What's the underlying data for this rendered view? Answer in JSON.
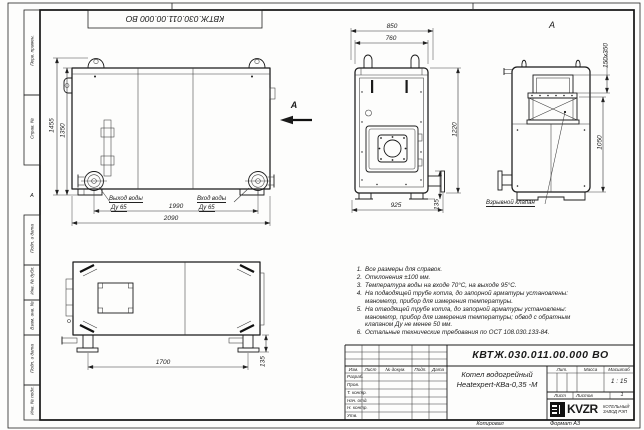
{
  "doc": {
    "number": "КВТЖ.030.011.00.000 ВО",
    "name_line1": "Котел водогрейный",
    "name_line2": "Heatexpert-КВа-0,35 -М",
    "scale_value": "1 : 15",
    "sheets_value": "1",
    "copy_label": "Копировал",
    "format_label": "Формат А3"
  },
  "frame": {
    "zone_letter": "А",
    "margin_labels": [
      "Перв. примен.",
      "Справ. №",
      "Подп. и дата",
      "Инв. № дубл.",
      "Взам. инв. №",
      "Подп. и дата",
      "Инв. № подл."
    ]
  },
  "titleblock": {
    "col_headers": [
      "Изм.",
      "Лист",
      "№ докум.",
      "Подп.",
      "Дата"
    ],
    "row_labels": [
      "Разраб.",
      "Пров.",
      "Т. контр.",
      "Нач. отд.",
      "Н. контр.",
      "Утв."
    ],
    "lit_label": "Лит.",
    "mass_label": "Масса",
    "scale_label": "Масштаб",
    "sheet_label": "Лист",
    "sheets_label": "Листов"
  },
  "logo": {
    "brand": "KVZR",
    "factory_line1": "КОТЕЛЬНЫЙ",
    "factory_line2": "ЗАВОД РЭП"
  },
  "views": {
    "side": {
      "dim_height_total": "1455",
      "dim_height_body": "1350",
      "dim_span_flanges": "1990",
      "dim_width_total": "2090",
      "outlet_label": "Выход воды",
      "outlet_dn": "Ду 65",
      "inlet_label": "Вход воды",
      "inlet_dn": "Ду 65",
      "view_arrow_label": "А"
    },
    "front": {
      "dim_width_total": "850",
      "dim_width_body": "760",
      "dim_height_body": "1220",
      "dim_width_base": "925",
      "dim_pipe_height": "135"
    },
    "rear": {
      "view_label": "А",
      "dim_flue": "150х350",
      "dim_height": "1050",
      "valve_label": "Взрывной клапан"
    },
    "plan": {
      "dim_feet_span": "1700",
      "dim_foot": "135"
    }
  },
  "notes": [
    {
      "num": "1.",
      "text": "Все размеры для справок."
    },
    {
      "num": "2.",
      "text": "Отклонения ±100 мм."
    },
    {
      "num": "3.",
      "text": "Температура воды на входе 70°С, на выходе 95°С."
    },
    {
      "num": "4.",
      "text": "На подводящей трубе котла, до запорной арматуры установлены: манометр, прибор для измерения температуры."
    },
    {
      "num": "5.",
      "text": "На отводящей трубе котла, до запорной арматуры установлены: манометр, прибор для измерения температуры; обвод с обратным клапаном Ду не менее 50 мм."
    },
    {
      "num": "6.",
      "text": "Остальные технические требования по ОСТ 108.030.133-84."
    }
  ]
}
